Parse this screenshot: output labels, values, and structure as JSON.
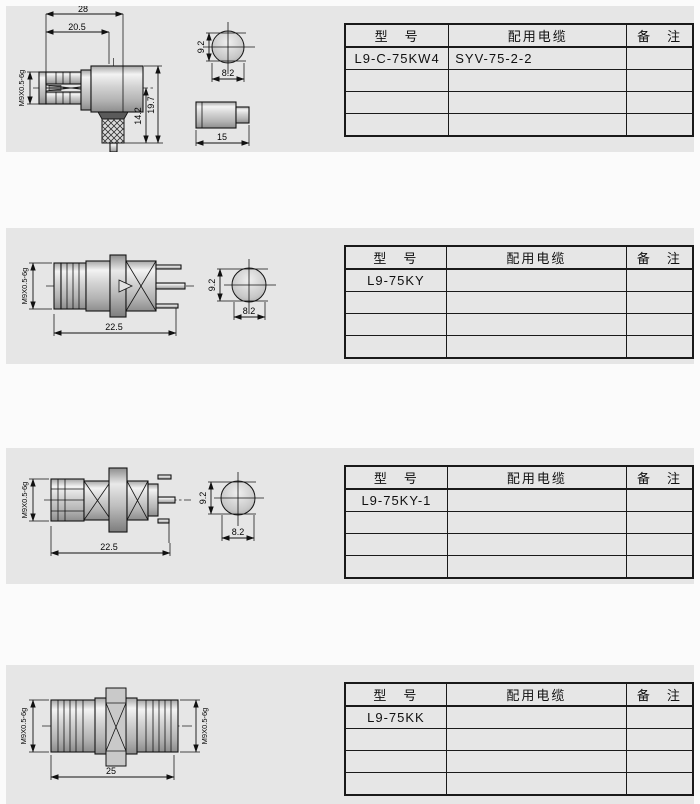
{
  "page": {
    "background": "#fbfbfb",
    "panel_background": "#e6e6e6",
    "line_color": "#141414"
  },
  "table_headers": {
    "model": "型　号",
    "cable": "配用电缆",
    "remarks": "备　注"
  },
  "sections": [
    {
      "model": "L9-C-75KW4",
      "cable": "SYV-75-2-2",
      "remarks": "",
      "dims": {
        "overall_width": "28",
        "body_width": "20.5",
        "thread": "M9X0.5-6g",
        "inner_height": "14.2",
        "overall_height": "19.7",
        "front_height": "9.2",
        "front_width": "8.2",
        "sleeve_length": "15"
      }
    },
    {
      "model": "L9-75KY",
      "cable": "",
      "remarks": "",
      "dims": {
        "thread": "M9X0.5-6g",
        "overall_length": "22.5",
        "front_height": "9.2",
        "front_width": "8.2"
      }
    },
    {
      "model": "L9-75KY-1",
      "cable": "",
      "remarks": "",
      "dims": {
        "thread": "M9X0.5-6g",
        "overall_length": "22.5",
        "front_height": "9.2",
        "front_width": "8.2"
      }
    },
    {
      "model": "L9-75KK",
      "cable": "",
      "remarks": "",
      "dims": {
        "thread_left": "M9X0.5-6g",
        "thread_right": "M9X0.5-6g",
        "overall_length": "25"
      }
    }
  ]
}
